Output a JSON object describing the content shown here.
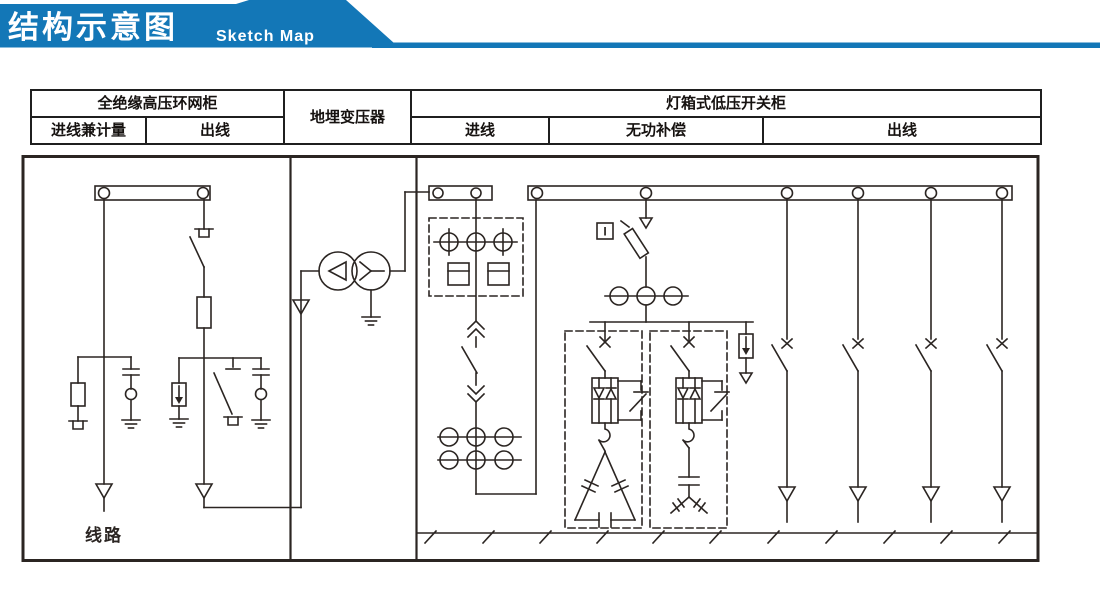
{
  "banner": {
    "title": "结构示意图",
    "subtitle": "Sketch Map",
    "accent_color": "#1377b7"
  },
  "legend_table": {
    "groups": {
      "hv": "全绝缘高压环网柜",
      "transformer": "地埋变压器",
      "lv": "灯箱式低压开关柜"
    },
    "columns": {
      "hv_incoming": "进线兼计量",
      "hv_outgoing": "出线",
      "lv_incoming": "进线",
      "lv_compensation": "无功补偿",
      "lv_outgoing": "出线"
    }
  },
  "diagram": {
    "line_label": "线路",
    "current_indicator_label": "I",
    "line_color": "#2b2522"
  }
}
